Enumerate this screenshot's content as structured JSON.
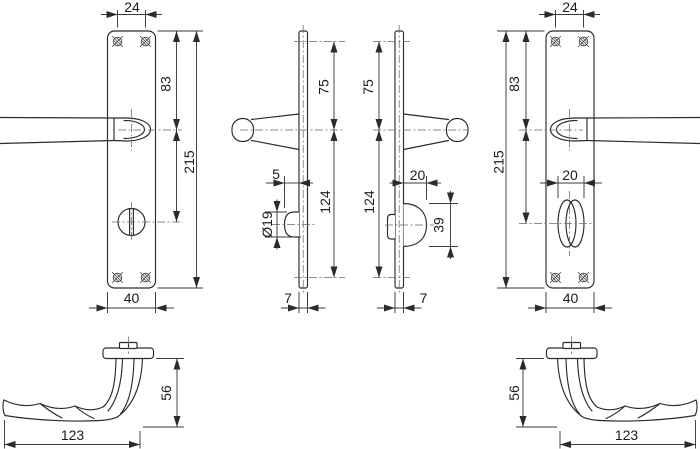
{
  "page": {
    "background": "#ffffff",
    "line_color": "#2b2b2b",
    "dimension_color": "#3a3a3a"
  },
  "views": {
    "front_left": {
      "hole_spacing_top": "24",
      "top_to_handle": "83",
      "plate_height": "215",
      "plate_width": "40"
    },
    "side_left": {
      "top_hole_to_handle": "75",
      "release_projection": "5",
      "release_diameter": "Ø19",
      "handle_to_bottom_hole": "124",
      "plate_thickness": "7"
    },
    "side_right": {
      "top_hole_to_handle": "75",
      "turn_projection": "20",
      "turn_knob_height": "39",
      "handle_to_bottom_hole": "124",
      "plate_thickness": "7"
    },
    "front_right": {
      "hole_spacing_top": "24",
      "top_to_handle": "83",
      "plate_height": "215",
      "turn_knob_width": "20",
      "plate_width": "40"
    },
    "lever_left": {
      "length": "123",
      "height": "56"
    },
    "lever_right": {
      "height": "56",
      "length": "123"
    }
  }
}
